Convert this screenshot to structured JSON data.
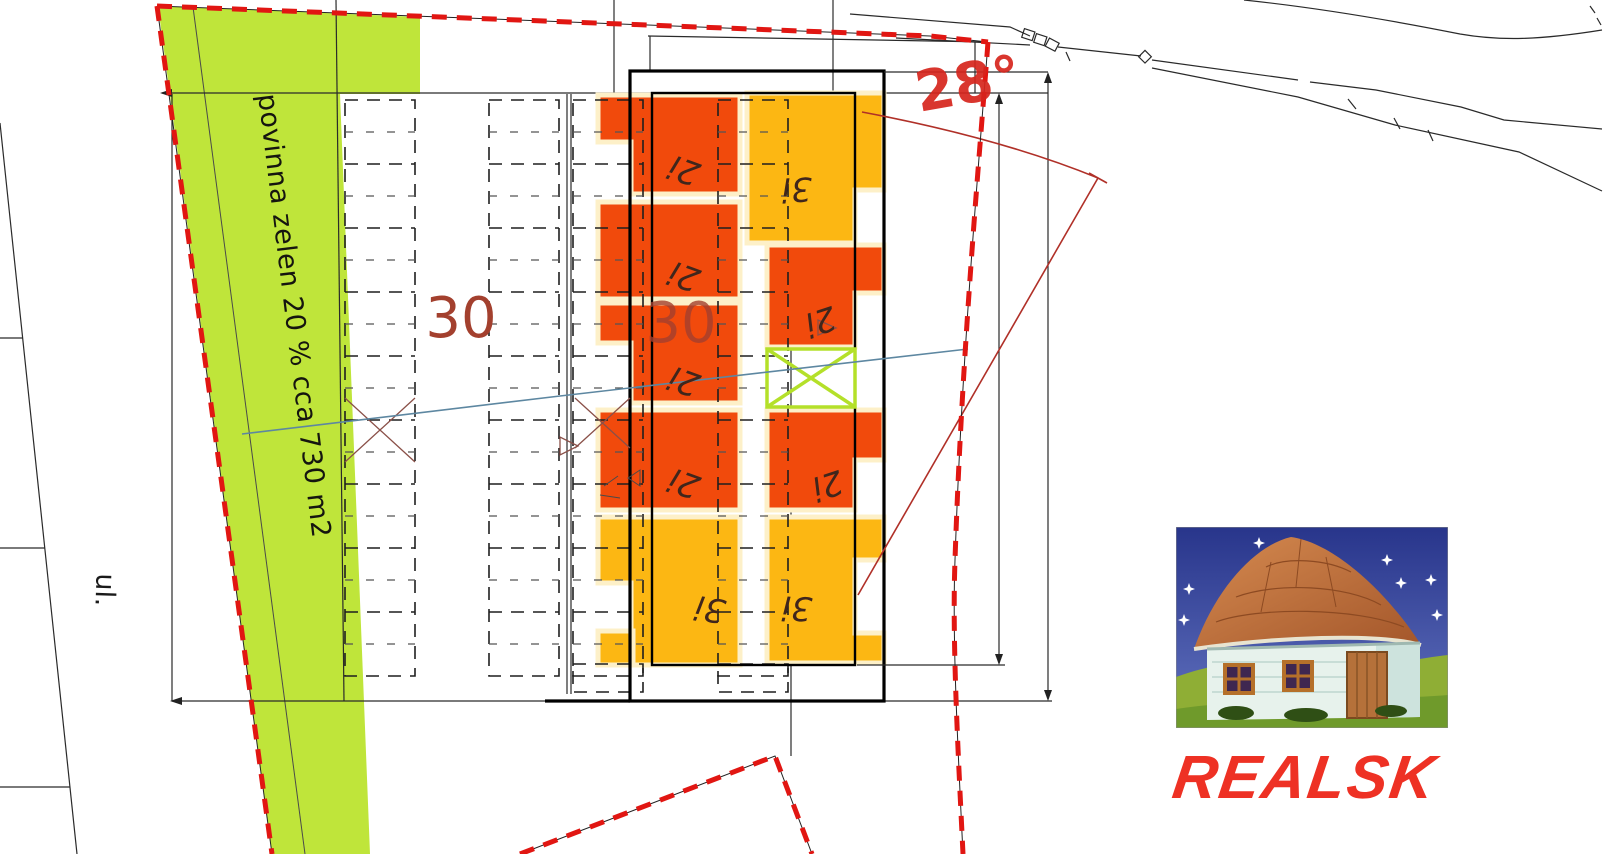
{
  "plan": {
    "green_area_label": "povinna zelen 20 % cca 730 m2",
    "street_label": "ul.",
    "roof_angle_label": "28°",
    "parcel_number_left": "30",
    "parcel_number_right": "30",
    "unit_labels": [
      "2i",
      "2i",
      "2i",
      "2i",
      "3i",
      "3i",
      "2i",
      "2i",
      "3i"
    ]
  },
  "logo": {
    "brand": "REALSK"
  },
  "colors": {
    "boundary_red": "#e11612",
    "green_area": "#bfe53a",
    "unit_orange": "#f14a0c",
    "unit_amber": "#fcb713",
    "annotation_red": "#b03028",
    "parcel_number_red": "#a3402e",
    "blue_line": "#5d87a1",
    "brand_red": "#ee3124"
  }
}
